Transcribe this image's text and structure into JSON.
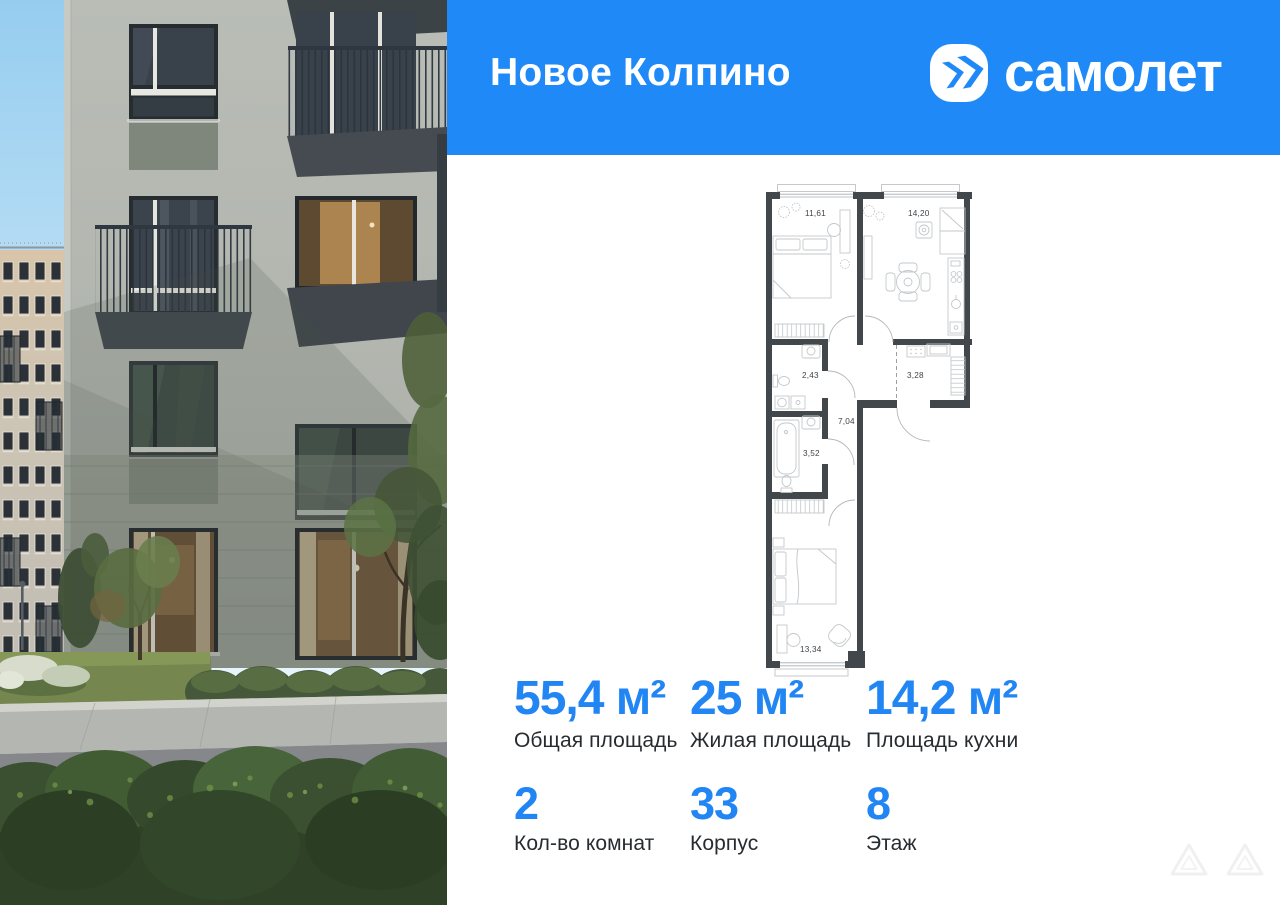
{
  "header": {
    "project_name": "Новое Колпино",
    "brand": "самолет",
    "bg_color": "#1f8af7",
    "text_color": "#ffffff"
  },
  "floor_plan": {
    "wall_color": "#42474b",
    "rooms": [
      {
        "name": "bedroom-top",
        "label": "11,61"
      },
      {
        "name": "kitchen",
        "label": "14,20"
      },
      {
        "name": "bathroom-upper",
        "label": "2,43"
      },
      {
        "name": "hallway",
        "label": "3,28"
      },
      {
        "name": "corridor",
        "label": "7,04"
      },
      {
        "name": "bathroom-lower",
        "label": "3,52"
      },
      {
        "name": "bedroom-bottom",
        "label": "13,34"
      }
    ]
  },
  "stats": {
    "accent_color": "#2186f4",
    "label_color": "#272c30",
    "row1": [
      {
        "value": "55,4 м²",
        "label": "Общая площадь"
      },
      {
        "value": "25 м²",
        "label": "Жилая площадь"
      },
      {
        "value": "14,2 м²",
        "label": "Площадь кухни"
      }
    ],
    "row2": [
      {
        "value": "2",
        "label": "Кол-во комнат"
      },
      {
        "value": "33",
        "label": "Корпус"
      },
      {
        "value": "8",
        "label": "Этаж"
      }
    ]
  }
}
